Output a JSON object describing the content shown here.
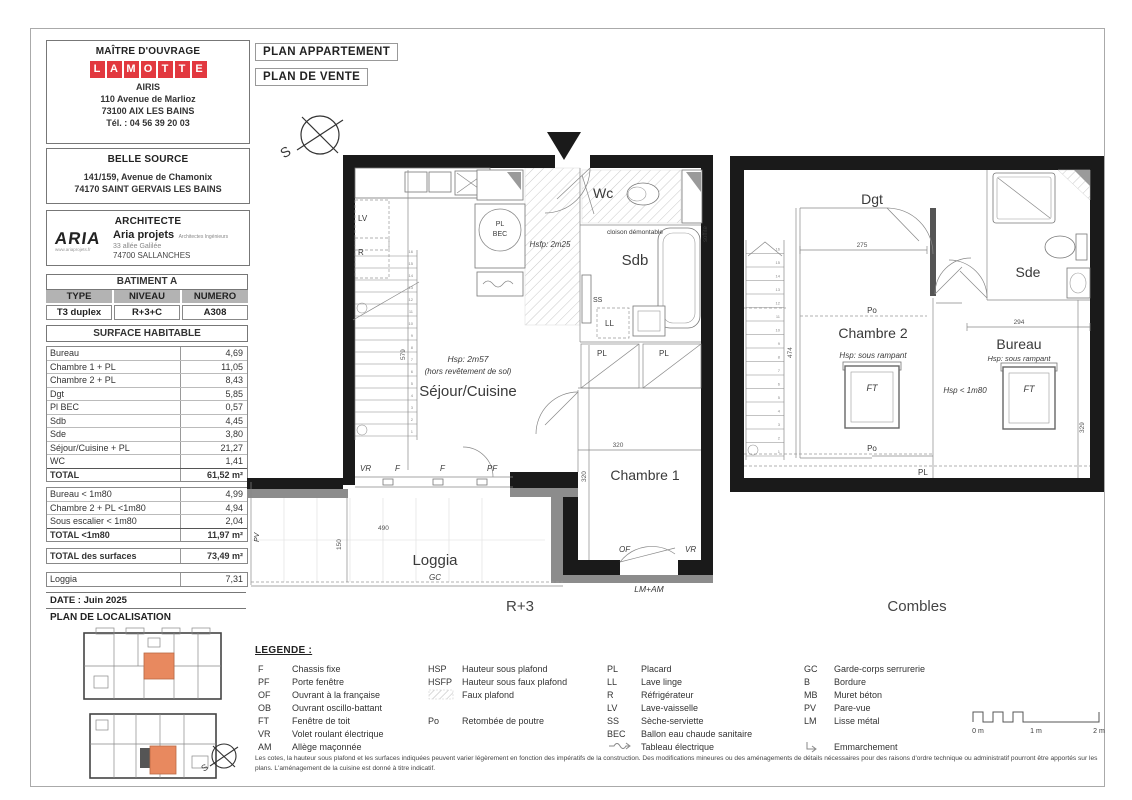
{
  "sheet": {
    "owner": {
      "title": "MAÎTRE D'OUVRAGE",
      "logo": [
        "L",
        "A",
        "M",
        "O",
        "T",
        "T",
        "E"
      ],
      "name": "AIRIS",
      "addr1": "110 Avenue de Marlioz",
      "addr2": "73100 AIX LES BAINS",
      "tel": "Tél. : 04 56 39 20 03"
    },
    "program": {
      "title": "BELLE SOURCE",
      "addr1": "141/159, Avenue de Chamonix",
      "addr2": "74170 SAINT GERVAIS LES BAINS"
    },
    "architect": {
      "title": "ARCHITECTE",
      "logo": "ARIA",
      "website": "www.ariaprojets.fr",
      "firm": "Aria projets",
      "firm_sub": "Architectes Ingénieurs",
      "addr1": "33 allée Galilée",
      "addr2": "74700 SALLANCHES"
    },
    "batiment": {
      "title": "BATIMENT A",
      "h1": "TYPE",
      "h2": "NIVEAU",
      "h3": "NUMERO",
      "v1": "T3 duplex",
      "v2": "R+3+C",
      "v3": "A308"
    },
    "surface": {
      "title": "SURFACE HABITABLE",
      "rows": [
        {
          "l": "Bureau",
          "v": "4,69"
        },
        {
          "l": "Chambre 1 + PL",
          "v": "11,05"
        },
        {
          "l": "Chambre 2 + PL",
          "v": "8,43"
        },
        {
          "l": "Dgt",
          "v": "5,85"
        },
        {
          "l": "Pl BEC",
          "v": "0,57"
        },
        {
          "l": "Sdb",
          "v": "4,45"
        },
        {
          "l": "Sde",
          "v": "3,80"
        },
        {
          "l": "Séjour/Cuisine + PL",
          "v": "21,27"
        },
        {
          "l": "WC",
          "v": "1,41"
        }
      ],
      "total": {
        "l": "TOTAL",
        "v": "61,52 m²"
      },
      "rows_under": [
        {
          "l": "Bureau < 1m80",
          "v": "4,99"
        },
        {
          "l": "Chambre 2 + PL <1m80",
          "v": "4,94"
        },
        {
          "l": "Sous escalier < 1m80",
          "v": "2,04"
        }
      ],
      "total_under": {
        "l": "TOTAL <1m80",
        "v": "11,97 m²"
      },
      "total_all": {
        "l": "TOTAL des surfaces",
        "v": "73,49 m²"
      },
      "loggia": {
        "l": "Loggia",
        "v": "7,31"
      }
    },
    "date": "DATE : Juin 2025",
    "localisation": "PLAN DE LOCALISATION"
  },
  "titles": {
    "t1": "PLAN APPARTEMENT",
    "t2": "PLAN DE VENTE"
  },
  "compass": {
    "s": "S"
  },
  "stairs": {
    "numbers": [
      "1",
      "2",
      "3",
      "4",
      "5",
      "6",
      "7",
      "8",
      "9",
      "10",
      "11",
      "12",
      "13",
      "14",
      "15",
      "16"
    ]
  },
  "plan_r3": {
    "name": "R+3",
    "sejour": "Séjour/Cuisine",
    "hsp": "Hsp: 2m57",
    "hsp_sub": "(hors revêtement de sol)",
    "chambre1": "Chambre 1",
    "wc": "Wc",
    "sdb": "Sdb",
    "cloison": "cloison démontable",
    "hsfp": "Hsfp: 2m25",
    "lv": "LV",
    "r": "R",
    "pl": "PL",
    "bec": "BEC",
    "ss": "SS",
    "ll": "LL",
    "pl1": "PL",
    "pl2": "PL",
    "soffite": "soffite",
    "vr": "VR",
    "f1": "F",
    "f2": "F",
    "pf": "PF",
    "of": "OF",
    "vr2": "VR",
    "lmam": "LM+AM",
    "loggia": "Loggia",
    "gc": "GC",
    "pv": "PV",
    "d579": "579",
    "d490": "490",
    "d150": "150",
    "d320h": "320",
    "d320v": "320"
  },
  "plan_combles": {
    "name": "Combles",
    "dgt": "Dgt",
    "sde": "Sde",
    "chambre2": "Chambre 2",
    "ch2_hsp": "Hsp: sous rampant",
    "bureau": "Bureau",
    "bureau_hsp": "Hsp: sous rampant",
    "hsp180": "Hsp < 1m80",
    "ft1": "FT",
    "ft2": "FT",
    "po1": "Po",
    "po2": "Po",
    "pl": "PL",
    "d275": "275",
    "d294": "294",
    "d474": "474",
    "d329": "329"
  },
  "legend": {
    "title": "LEGENDE :",
    "col1": [
      {
        "a": "F",
        "d": "Chassis fixe"
      },
      {
        "a": "PF",
        "d": "Porte fenêtre"
      },
      {
        "a": "OF",
        "d": "Ouvrant à la française"
      },
      {
        "a": "OB",
        "d": "Ouvrant oscillo-battant"
      },
      {
        "a": "FT",
        "d": "Fenêtre de toit"
      },
      {
        "a": "VR",
        "d": "Volet roulant électrique"
      },
      {
        "a": "AM",
        "d": "Allège maçonnée"
      }
    ],
    "col2": [
      {
        "a": "HSP",
        "d": "Hauteur sous plafond"
      },
      {
        "a": "HSFP",
        "d": "Hauteur sous faux plafond"
      },
      {
        "a": "",
        "d": "Faux plafond"
      },
      {
        "a": "Po",
        "d": "Retombée de poutre"
      }
    ],
    "col3": [
      {
        "a": "PL",
        "d": "Placard"
      },
      {
        "a": "LL",
        "d": "Lave linge"
      },
      {
        "a": "R",
        "d": "Réfrigérateur"
      },
      {
        "a": "LV",
        "d": "Lave-vaisselle"
      },
      {
        "a": "SS",
        "d": "Sèche-serviette"
      },
      {
        "a": "BEC",
        "d": "Ballon eau chaude sanitaire"
      },
      {
        "a": "",
        "d": "Tableau électrique"
      }
    ],
    "col4": [
      {
        "a": "GC",
        "d": "Garde-corps serrurerie"
      },
      {
        "a": "B",
        "d": "Bordure"
      },
      {
        "a": "MB",
        "d": "Muret béton"
      },
      {
        "a": "PV",
        "d": "Pare-vue"
      },
      {
        "a": "LM",
        "d": "Lisse métal"
      },
      {
        "a": "",
        "d": "Emmarchement"
      }
    ]
  },
  "footnote": "Les cotes, la hauteur sous plafond et les surfaces indiquées peuvent varier légèrement en fonction des impératifs de la construction. Des modifications mineures ou des aménagements de détails nécessaires pour des raisons d'ordre technique ou administratif pourront être apportés sur les plans. L'aménagement de la cuisine est donné à titre indicatif.",
  "scale": {
    "l0": "0 m",
    "l1": "1 m",
    "l2": "2 m"
  },
  "colors": {
    "accent_red": "#e2383f",
    "unit_orange": "#e8895f",
    "wall_black": "#1a1a1a"
  }
}
